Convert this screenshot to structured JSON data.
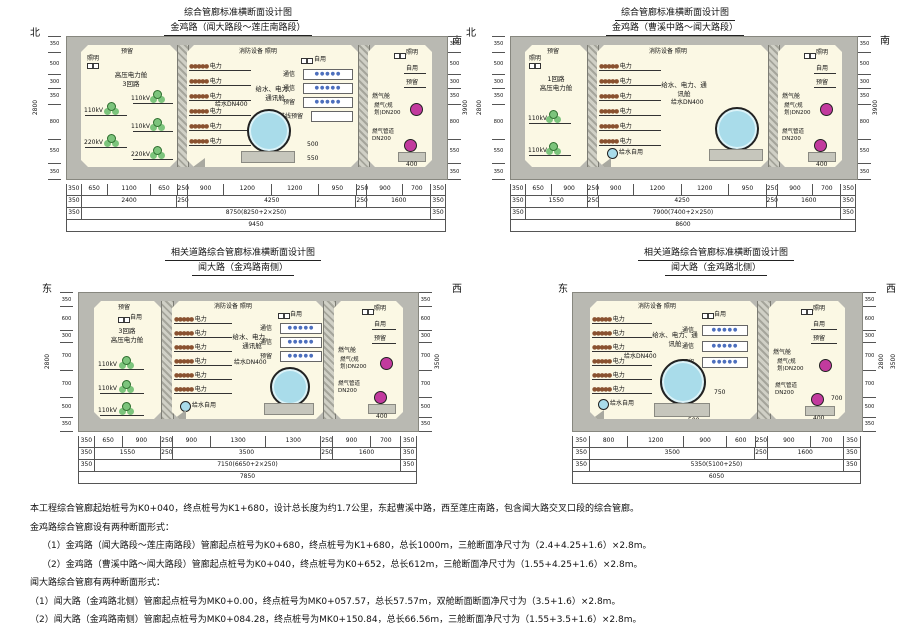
{
  "labels": {
    "power": "电力",
    "telecom": "通信",
    "reserved": "预留",
    "reserve_in": "进线预留",
    "self_use": "自用",
    "lighting": "照明",
    "fire_lighting": "消防设备 照明",
    "water_main": "给水DN400",
    "water_self": "给水自用",
    "gas_planned": "燃气(规划)DN200",
    "gas_pipe": "燃气管道DN200",
    "gas_cabin": "燃气舱",
    "hv_cabin": "高压电力舱",
    "combo_cabin": "给水、电力、通讯舱",
    "kv110": "110kV",
    "kv220": "220kV",
    "dots_power": "●●●●●",
    "dots_tel": "●●●●●"
  },
  "inner_dims": {
    "d400": "400",
    "d500": "500",
    "d550": "550",
    "d700": "700",
    "d750": "750"
  },
  "panels": [
    {
      "title": "综合管廊标准横断面设计图",
      "subtitle": "金鸡路（闻大路段～莲庄南路段）",
      "dir_left": "北",
      "dir_right": "南",
      "comp1_line1": "高压电力舱",
      "comp1_line2": "3回路",
      "vchain": [
        "350",
        "500",
        "300",
        "350",
        "800",
        "550",
        "350"
      ],
      "vtotals": [
        "2800",
        "3900"
      ],
      "dims": [
        [
          "350",
          "650",
          "1100",
          "650",
          "250",
          "900",
          "1200",
          "1200",
          "950",
          "250",
          "900",
          "700",
          "350"
        ],
        [
          "350",
          "2400",
          "250",
          "4250",
          "250",
          "1600",
          "350"
        ],
        [
          "350",
          "8750(8250+2×250)",
          "350"
        ],
        [
          "9450"
        ]
      ]
    },
    {
      "title": "综合管廊标准横断面设计图",
      "subtitle": "金鸡路（曹溪中路～闻大路段）",
      "dir_left": "北",
      "dir_right": "南",
      "comp1_line1": "1回路",
      "comp1_line2": "高压电力舱",
      "vchain": [
        "350",
        "500",
        "300",
        "350",
        "800",
        "550",
        "350"
      ],
      "vtotals": [
        "2800",
        "3900"
      ],
      "dims": [
        [
          "350",
          "650",
          "900",
          "250",
          "900",
          "1200",
          "1200",
          "950",
          "250",
          "900",
          "700",
          "350"
        ],
        [
          "350",
          "1550",
          "250",
          "4250",
          "250",
          "1600",
          "350"
        ],
        [
          "350",
          "7900(7400+2×250)",
          "350"
        ],
        [
          "8600"
        ]
      ]
    },
    {
      "title": "相关道路综合管廊标准横断面设计图",
      "subtitle": "闻大路（金鸡路南侧）",
      "dir_left": "东",
      "dir_right": "西",
      "comp1_line1": "3回路",
      "comp1_line2": "高压电力舱",
      "vchain": [
        "350",
        "600",
        "300",
        "700",
        "700",
        "500",
        "350"
      ],
      "vtotals": [
        "2800",
        "3500"
      ],
      "dims": [
        [
          "350",
          "650",
          "900",
          "250",
          "900",
          "1300",
          "1300",
          "250",
          "900",
          "700",
          "350"
        ],
        [
          "350",
          "1550",
          "250",
          "3500",
          "250",
          "1600",
          "350"
        ],
        [
          "350",
          "7150(6650+2×250)",
          "350"
        ],
        [
          "7850"
        ]
      ]
    },
    {
      "title": "相关道路综合管廊标准横断面设计图",
      "subtitle": "闻大路（金鸡路北侧）",
      "dir_left": "东",
      "dir_right": "西",
      "vchain": [
        "350",
        "600",
        "300",
        "700",
        "700",
        "500",
        "350"
      ],
      "vtotals": [
        "2800",
        "3500"
      ],
      "dims": [
        [
          "350",
          "800",
          "1200",
          "900",
          "600",
          "250",
          "900",
          "700",
          "350"
        ],
        [
          "350",
          "3500",
          "250",
          "1600",
          "350"
        ],
        [
          "350",
          "5350(5100+250)",
          "350"
        ],
        [
          "6050"
        ]
      ]
    }
  ],
  "notes": [
    "本工程综合管廊起始桩号为K0+040，终点桩号为K1+680，设计总长度为约1.7公里，东起曹溪中路，西至莲庄南路，包含闻大路交叉口段的综合管廊。",
    "金鸡路综合管廊设有两种断面形式：",
    "（1）金鸡路（闻大路段～莲庄南路段）管廊起点桩号为K0+680，终点桩号为K1+680，总长1000m，三舱断面净尺寸为（2.4+4.25+1.6）×2.8m。",
    "（2）金鸡路（曹溪中路～闻大路段）管廊起点桩号为K0+040，终点桩号为K0+652，总长612m，三舱断面净尺寸为（1.55+4.25+1.6）×2.8m。",
    "闻大路综合管廊有两种断面形式：",
    "（1）闻大路（金鸡路北侧）管廊起点桩号为MK0+0.00，终点桩号为MK0+057.57，总长57.57m，双舱断面断面净尺寸为（3.5+1.6）×2.8m。",
    "（2）闻大路（金鸡路南侧）管廊起点桩号为MK0+084.28，终点桩号为MK0+150.84，总长66.56m，三舱断面净尺寸为（1.55+3.5+1.6）×2.8m。"
  ]
}
